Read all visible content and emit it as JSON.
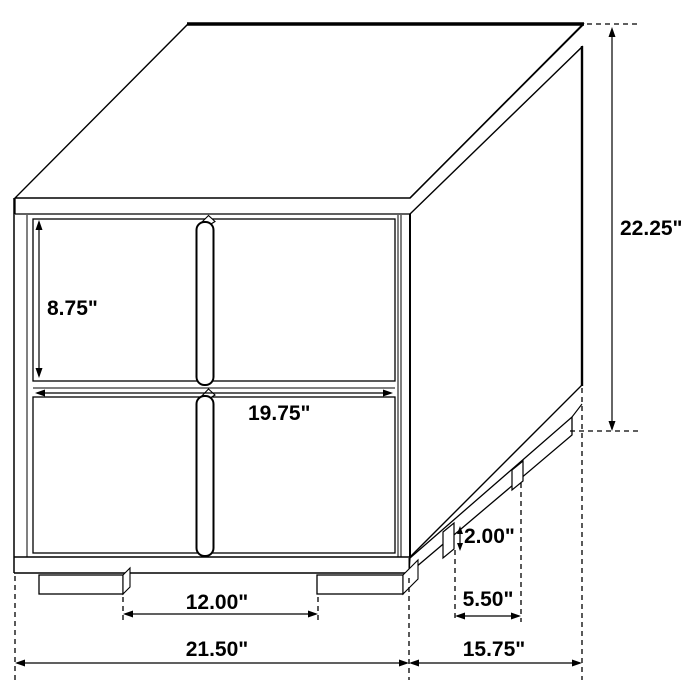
{
  "diagram": {
    "subject": "nightstand-dimension-drawing",
    "view": "isometric line drawing, two drawers with center vertical handle, plinth base with feet",
    "unit": "inches",
    "colors": {
      "line": "#000000",
      "background": "#ffffff"
    },
    "labels": {
      "drawer_height": "8.75\"",
      "drawer_width": "19.75\"",
      "overall_height": "22.25\"",
      "foot_height": "2.00\"",
      "side_feet_gap": "5.50\"",
      "front_feet_gap": "12.00\"",
      "overall_width": "21.50\"",
      "overall_depth": "15.75\""
    }
  }
}
